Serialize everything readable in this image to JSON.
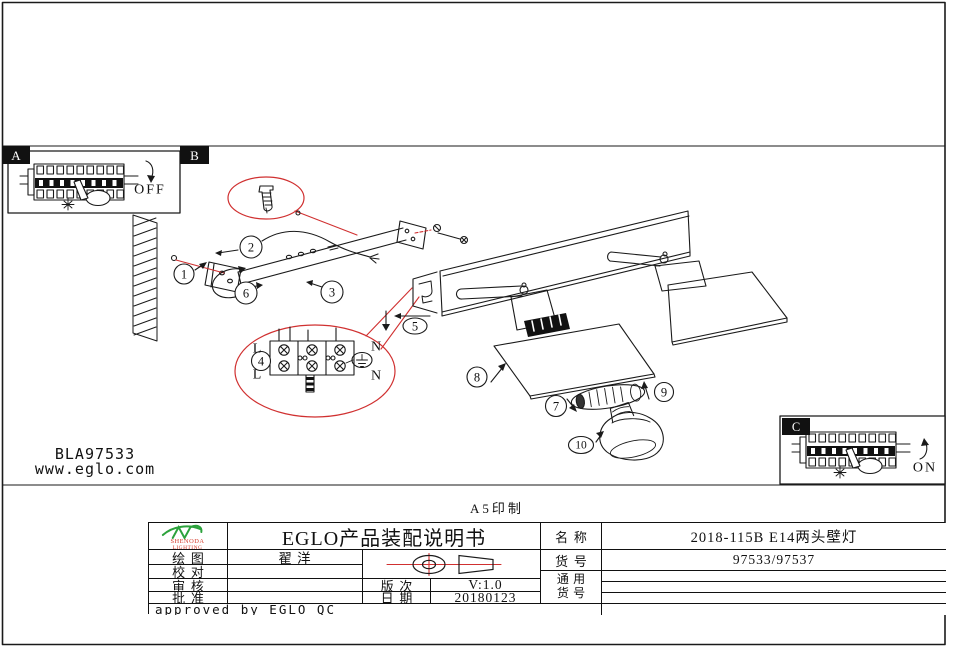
{
  "colors": {
    "line": "#1a1a1a",
    "red": "#d03030",
    "logo_green": "#2ca23c",
    "logo_red": "#d43a2a"
  },
  "panels": {
    "a_label": "A",
    "b_label": "B",
    "c_label": "C",
    "off": "OFF",
    "on": "ON"
  },
  "steps": [
    "1",
    "2",
    "3",
    "4",
    "5",
    "6",
    "7",
    "8",
    "9",
    "10"
  ],
  "terminal": {
    "live_top": "L",
    "live_bottom": "L",
    "neutral_top": "N",
    "neutral_bottom": "N"
  },
  "footer": {
    "code": "BLA97533",
    "url": "www.eglo.com",
    "print_note": "A5印制"
  },
  "title_block": {
    "logo": {
      "line1": "SHENODA",
      "line2": "LIGHTING"
    },
    "title": "EGLO产品装配说明书",
    "rows": {
      "draw_label": "绘图",
      "draw_value": "翟 洋",
      "check_label": "校对",
      "check_value": "",
      "audit_label": "审核",
      "audit_value": "",
      "approve_label": "批准",
      "approve_value": "",
      "version_label": "版次",
      "version_value": "V:1.0",
      "date_label": "日期",
      "date_value": "20180123",
      "name_label": "名称",
      "name_value": "2018-115B E14两头壁灯",
      "item_label": "货号",
      "item_value": "97533/97537",
      "common_label_line1": "通用",
      "common_label_line2": "货号",
      "approved_note": "approved by EGLO QC"
    }
  }
}
